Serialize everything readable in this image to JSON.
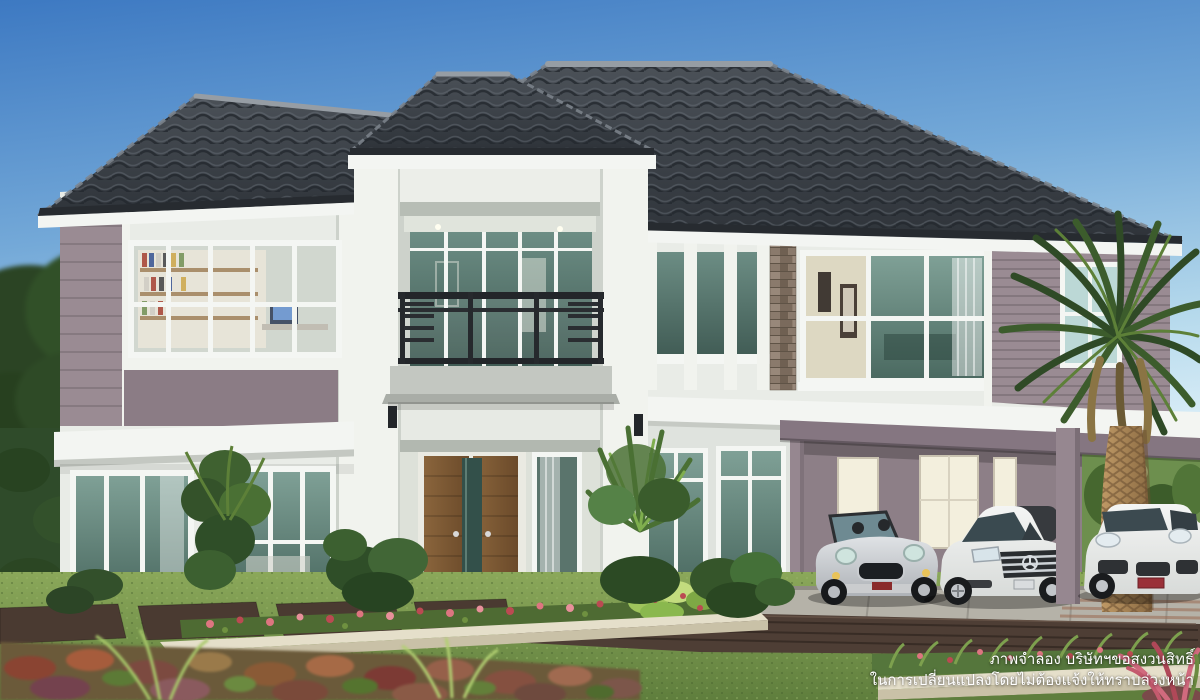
{
  "disclaimer": {
    "line1": "ภาพจำลอง บริษัทฯขอสงวนสิทธิ์",
    "line2": "ในการเปลี่ยนแปลงโดยไม่ต้องแจ้งให้ทราบล่วงหน้า"
  },
  "colors": {
    "sky_top": "#3d79c2",
    "sky_mid": "#74a9d8",
    "sky_low": "#d9edf7",
    "roof_dark": "#32373d",
    "roof_light": "#4b5158",
    "roof_ridge": "#969da4",
    "fascia": "#f3f5f2",
    "wall": "#e9ece7",
    "wall_shade": "#dfe3de",
    "pillar": "#f1f3ee",
    "mauve": "#9a8b93",
    "mauve_dark": "#8b7c85",
    "mauve_deep": "#857681",
    "glass": "#6f9187",
    "glass_dark": "#44605a",
    "glass_light": "#bcd8d6",
    "frame": "#f4f6f3",
    "cream": "#ddd8c2",
    "wood": "#7d5a36",
    "stone": "#8d7c6c",
    "lawn": "#85a355",
    "lawn_dark": "#61803f",
    "hedge": "#2f4b2a",
    "leaf": "#4d7335",
    "leaf_light": "#7fae4e",
    "palm_leaf": "#3c5c2c",
    "palm_leaf_light": "#5d8038",
    "trunk": "#b3905f",
    "trunk_dark": "#7c5f3b",
    "planter": "#e5dfca",
    "planter_shade": "#c9c1a7",
    "deck": "#4e3e35",
    "deck_dark": "#382c25",
    "concrete": "#b5b2a8",
    "paver": "#4a3a31",
    "flower_pink": "#dd7580",
    "flower_red": "#bb4a52",
    "corner_pink": "#d16a7e",
    "car_silver": "#c7cbcf",
    "car_white": "#eef0ee",
    "car_glass": "#3c4a50",
    "car_dark": "#1d2023",
    "chrome": "#ccd1d5",
    "lamp_dark": "#23262a",
    "interior_warm": "#f3efdd",
    "text_white": "#ffffff"
  }
}
